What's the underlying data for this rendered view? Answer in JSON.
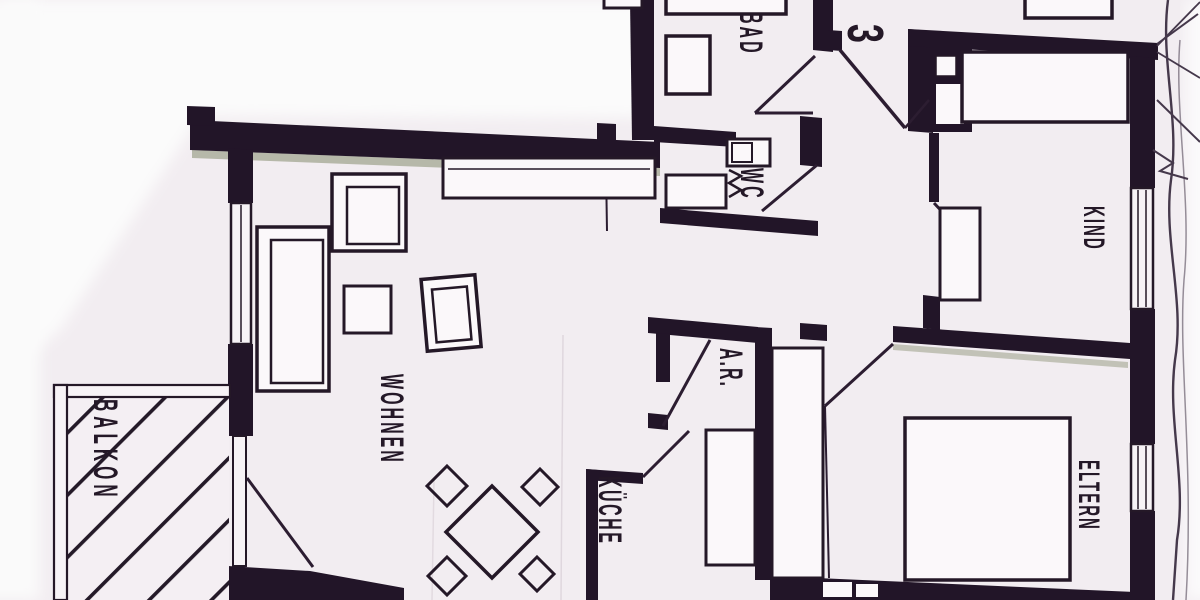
{
  "floor_plan": {
    "unit_number": "3",
    "rooms": [
      {
        "id": "wohnen",
        "label": "WOHNEN"
      },
      {
        "id": "kueche",
        "label": "KÜCHE"
      },
      {
        "id": "bad",
        "label": "BAD"
      },
      {
        "id": "wc",
        "label": "WC"
      },
      {
        "id": "ar",
        "label": "A.R."
      },
      {
        "id": "kind",
        "label": "KIND"
      },
      {
        "id": "eltern",
        "label": "ELTERN"
      },
      {
        "id": "balkon",
        "label": "BALKON"
      }
    ]
  },
  "colors": {
    "ink": "#241827",
    "paper": "#f2edf1",
    "wall_shadow_green": "#7a8261"
  }
}
